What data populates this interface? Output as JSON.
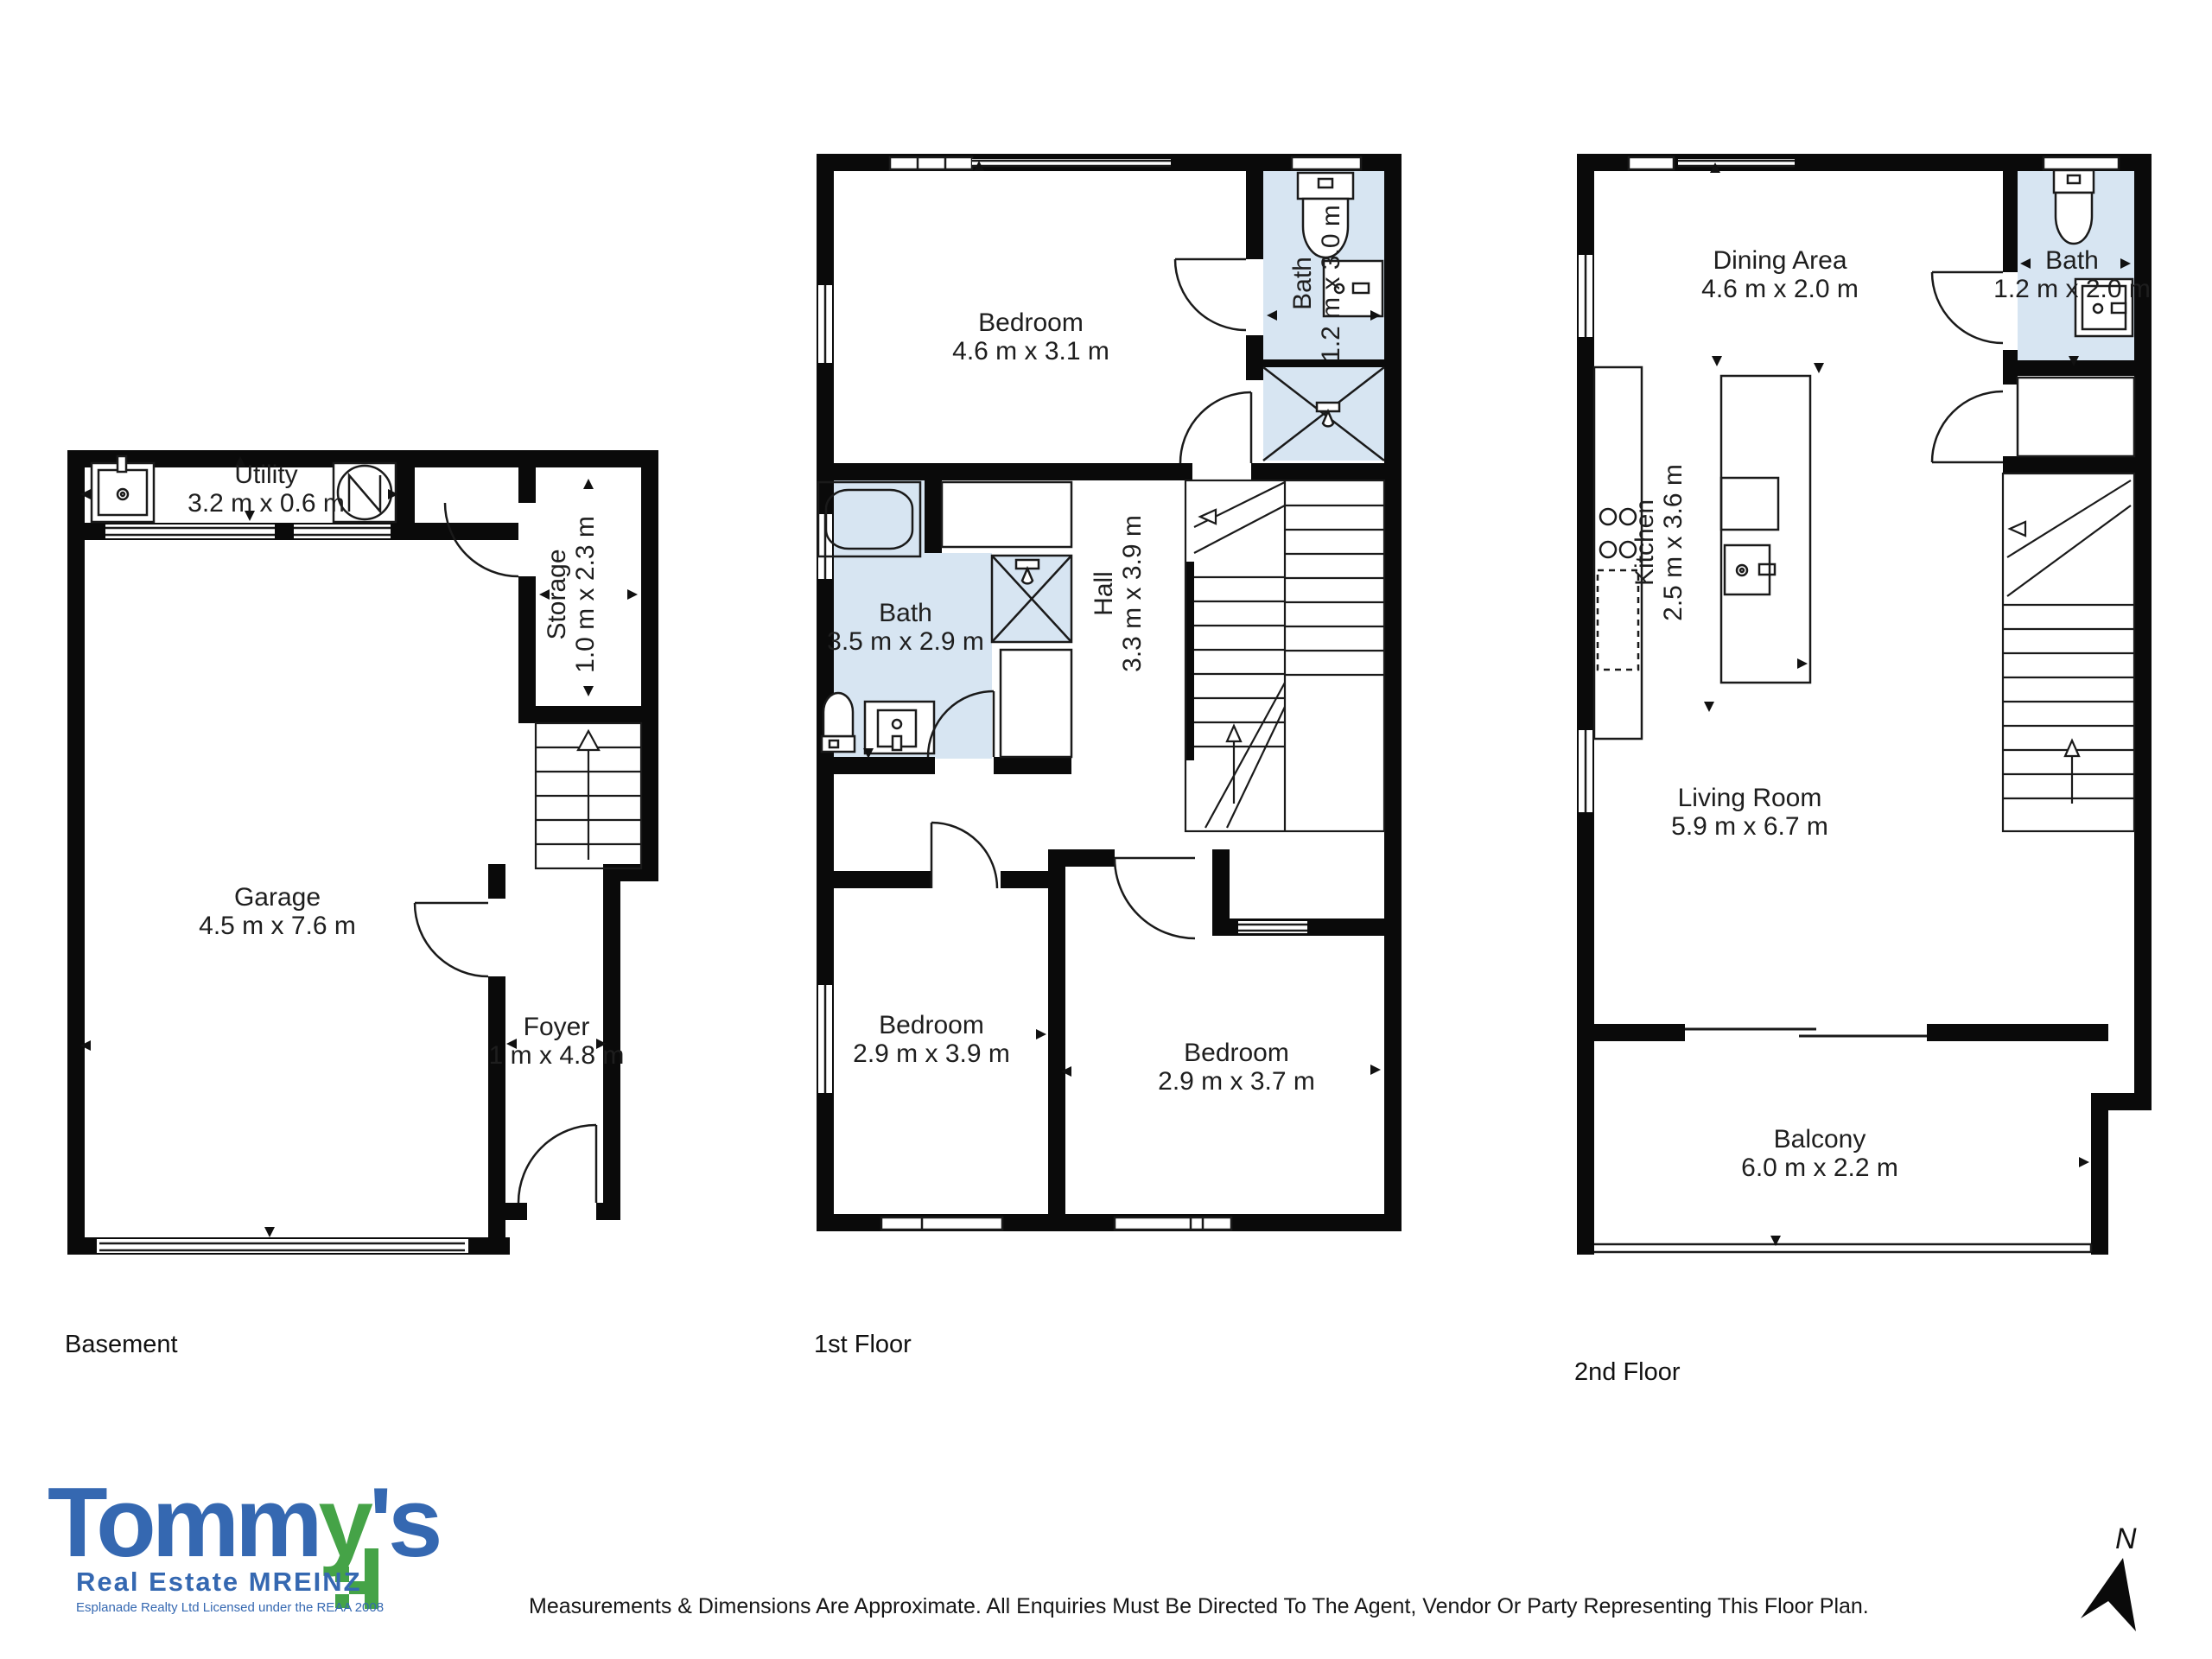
{
  "floors": [
    {
      "label": "Basement",
      "rooms": [
        {
          "name": "Utility",
          "dims": "3.2 m x 0.6 m"
        },
        {
          "name": "Storage",
          "dims": "1.0 m x 2.3 m"
        },
        {
          "name": "Garage",
          "dims": "4.5 m x 7.6 m"
        },
        {
          "name": "Foyer",
          "dims": "1 m x 4.8 m"
        }
      ]
    },
    {
      "label": "1st Floor",
      "rooms": [
        {
          "name": "Bedroom",
          "dims": "4.6 m x 3.1 m"
        },
        {
          "name": "Bath",
          "dims": "1.2 m x 3.0 m"
        },
        {
          "name": "Bath",
          "dims": "3.5 m x 2.9 m"
        },
        {
          "name": "Hall",
          "dims": "3.3 m x 3.9 m"
        },
        {
          "name": "Bedroom",
          "dims": "2.9 m x 3.9 m"
        },
        {
          "name": "Bedroom",
          "dims": "2.9 m x 3.7 m"
        }
      ]
    },
    {
      "label": "2nd Floor",
      "rooms": [
        {
          "name": "Dining Area",
          "dims": "4.6 m x 2.0 m"
        },
        {
          "name": "Bath",
          "dims": "1.2 m x 2.0 m"
        },
        {
          "name": "Kitchen",
          "dims": "2.5 m x 3.6 m"
        },
        {
          "name": "Living Room",
          "dims": "5.9 m x 6.7 m"
        },
        {
          "name": "Balcony",
          "dims": "6.0 m x 2.2 m"
        }
      ]
    }
  ],
  "logo": {
    "brand_prefix": "Tomm",
    "brand_green": "y",
    "brand_suffix": "'s",
    "tagline": "Real Estate MREINZ",
    "license": "Esplanade Realty Ltd Licensed under the REAA 2008"
  },
  "compass": {
    "label": "N"
  },
  "disclaimer": "Measurements & Dimensions Are Approximate. All Enquiries Must Be Directed To The Agent, Vendor Or Party Representing This Floor Plan.",
  "colors": {
    "wall": "#0a0a0a",
    "bath_fill": "#d7e5f2",
    "logo_blue": "#3568b1",
    "logo_green": "#45a347"
  }
}
